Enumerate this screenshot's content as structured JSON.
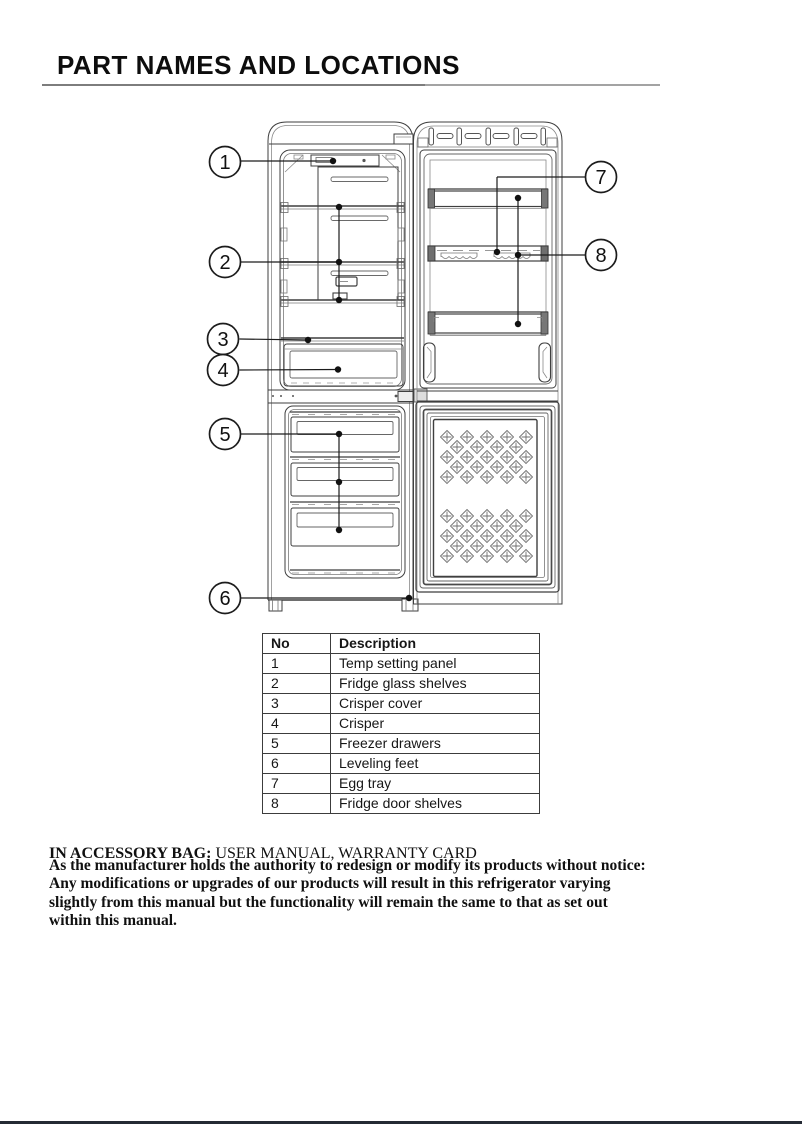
{
  "page": {
    "title": "PART NAMES AND LOCATIONS"
  },
  "diagram": {
    "description": "refrigerator-part-locations-line-drawing",
    "callout_numbers": [
      "1",
      "2",
      "3",
      "4",
      "5",
      "6",
      "7",
      "8"
    ]
  },
  "table": {
    "headers": {
      "no": "No",
      "description": "Description"
    },
    "rows": [
      {
        "no": "1",
        "desc": "Temp setting panel"
      },
      {
        "no": "2",
        "desc": "Fridge glass shelves"
      },
      {
        "no": "3",
        "desc": "Crisper cover"
      },
      {
        "no": "4",
        "desc": "Crisper"
      },
      {
        "no": "5",
        "desc": "Freezer drawers"
      },
      {
        "no": "6",
        "desc": "Leveling feet"
      },
      {
        "no": "7",
        "desc": "Egg tray"
      },
      {
        "no": "8",
        "desc": "Fridge door shelves"
      }
    ]
  },
  "accessory": {
    "label": "IN ACCESSORY BAG:",
    "value": " USER MANUAL, WARRANTY CARD"
  },
  "notice": {
    "lines": [
      "As the manufacturer holds the authority to redesign or modify its products without notice:",
      "Any modifications or upgrades of our products will result in this refrigerator varying",
      "slightly from this manual but the functionality will remain the same to that as set out",
      "within this manual."
    ]
  },
  "colors": {
    "line_dark": "#1c1c1c",
    "line_mid": "#3f3f3f",
    "line_light": "#8a8a8a",
    "bottom_rule": "#242a34"
  }
}
